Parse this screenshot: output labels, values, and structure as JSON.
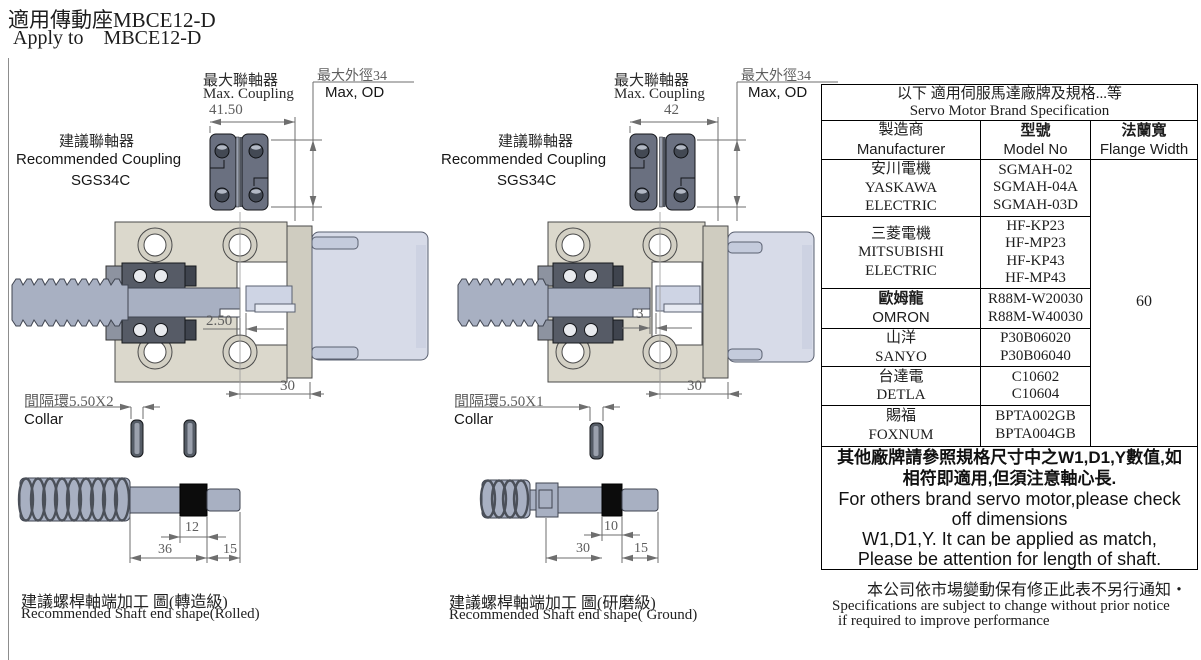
{
  "title": {
    "line1": "適用傳動座MBCE12-D",
    "line2": "Apply to    MBCE12-D"
  },
  "drawings": {
    "left": {
      "max_coupling_zh": "最大聯軸器",
      "max_coupling_en": "Max. Coupling",
      "coupling_width": "41.50",
      "max_od_zh": "最大外徑34",
      "max_od_en": "Max, OD",
      "rec_coupling_zh": "建議聯軸器",
      "rec_coupling_en": "Recommended Coupling",
      "rec_coupling_model": "SGS34C",
      "gap_dim": "2.50",
      "depth_dim": "30",
      "collar_zh": "間隔環5.50X2",
      "collar_en": "Collar",
      "shaft_dim_mid": "12",
      "shaft_dim_main": "36",
      "shaft_dim_end": "15",
      "caption_zh": "建議螺桿軸端加工 圖(轉造級)",
      "caption_en": "Recommended Shaft end shape(Rolled)"
    },
    "right": {
      "max_coupling_zh": "最大聯軸器",
      "max_coupling_en": "Max. Coupling",
      "coupling_width": "42",
      "max_od_zh": "最大外徑34",
      "max_od_en": "Max, OD",
      "rec_coupling_zh": "建議聯軸器",
      "rec_coupling_en": "Recommended Coupling",
      "rec_coupling_model": "SGS34C",
      "gap_dim": "3",
      "depth_dim": "30",
      "collar_zh": "間隔環5.50X1",
      "collar_en": "Collar",
      "shaft_dim_mid": "10",
      "shaft_dim_main": "30",
      "shaft_dim_end": "15",
      "caption_zh": "建議螺桿軸端加工 圖(研磨級)",
      "caption_en": "Recommended Shaft end shape( Ground)"
    }
  },
  "table": {
    "title_zh": "以下 適用伺服馬達廠牌及規格...等",
    "title_en": "Servo Motor Brand Specification",
    "headers": {
      "manufacturer_zh": "製造商",
      "manufacturer_en": "Manufacturer",
      "model_zh": "型號",
      "model_en": "Model No",
      "flange_zh": "法蘭寬",
      "flange_en": "Flange Width"
    },
    "flange_width": "60",
    "rows": [
      {
        "mfr": [
          "安川電機",
          "YASKAWA",
          "ELECTRIC"
        ],
        "models": [
          "SGMAH-02",
          "SGMAH-04A",
          "SGMAH-03D"
        ]
      },
      {
        "mfr": [
          "三菱電機",
          "MITSUBISHI",
          "ELECTRIC"
        ],
        "models": [
          "HF-KP23",
          "HF-MP23",
          "HF-KP43",
          "HF-MP43"
        ]
      },
      {
        "mfr": [
          "歐姆龍",
          "OMRON"
        ],
        "models": [
          "R88M-W20030",
          "R88M-W40030"
        ]
      },
      {
        "mfr": [
          "山洋",
          "SANYO"
        ],
        "models": [
          "P30B06020",
          "P30B06040"
        ]
      },
      {
        "mfr": [
          "台達電",
          "DETLA"
        ],
        "models": [
          "C10602",
          "C10604"
        ]
      },
      {
        "mfr": [
          "賜福",
          "FOXNUM"
        ],
        "models": [
          "BPTA002GB",
          "BPTA004GB"
        ]
      }
    ],
    "note_lines": [
      "其他廠牌請參照規格尺寸中之W1,D1,Y數值,如",
      "相符即適用,但須注意軸心長.",
      "For others brand servo motor,please check",
      "off dimensions",
      "W1,D1,Y. It can be applied as match,",
      "Please be attention for length of shaft."
    ]
  },
  "footer": {
    "zh": "本公司依市場變動保有修正此表不另行通知・",
    "en_line1": "Specifications are subject to change without prior notice",
    "en_line2": "if required to improve performance"
  }
}
